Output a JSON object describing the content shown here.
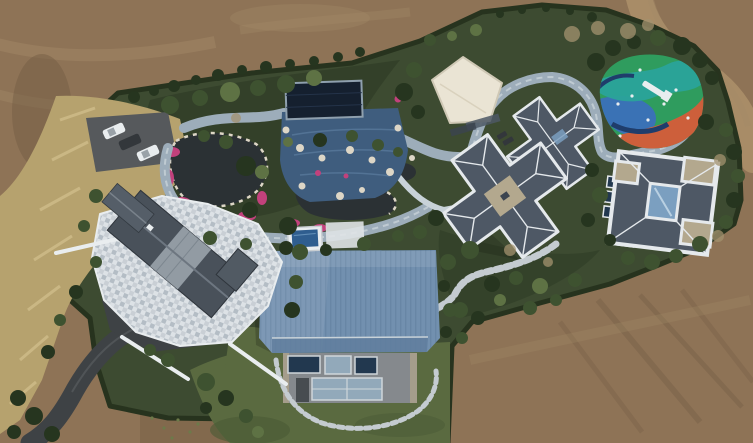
{
  "scene": {
    "type": "aerial-drone-photograph",
    "setting": "landscaped private estate surrounded by bare brown earth",
    "landmarks": [
      {
        "name": "parking-area",
        "vehicles_visible": 3
      },
      {
        "name": "ornamental-pond-garden",
        "features": [
          "dark pond",
          "pink flower beds",
          "white rocks"
        ]
      },
      {
        "name": "pool-pavilion",
        "features": [
          "dark navy cover",
          "blue tiled deck"
        ]
      },
      {
        "name": "cream-flat-roof-building"
      },
      {
        "name": "children-playground",
        "features": [
          "green blue teal orange painted surface",
          "white slide"
        ]
      },
      {
        "name": "slate-roof-villa-middle"
      },
      {
        "name": "slate-roof-villa-right",
        "features": [
          "white parapet",
          "glass courtyard"
        ]
      },
      {
        "name": "blue-metal-roof-barn",
        "features": [
          "corrugated steel-blue roof",
          "windows",
          "curved stepping-stone path"
        ]
      },
      {
        "name": "terrace-house",
        "features": [
          "dark gable roof",
          "light mosaic terrace"
        ]
      },
      {
        "name": "winding-garden-paths"
      },
      {
        "name": "asphalt-access-road"
      },
      {
        "name": "dirt-road-top-right"
      },
      {
        "name": "boundary-hedge"
      }
    ]
  },
  "palette": {
    "dirtBase": "#8e7356",
    "dirtLight": "#a38a68",
    "dirtDark": "#715a42",
    "dirtRoad": "#a88c67",
    "hedge": "#27331e",
    "garden": "#3d4b31",
    "gardenDark": "#2f3c27",
    "lawn": "#5a6a40",
    "lawnDark": "#4a5a36",
    "dryGrass": "#b6a26e",
    "dryGrassLight": "#cfbd8a",
    "bushOlive": "#5c6240",
    "treeDark": "#26351f",
    "treeMid": "#3e5230",
    "treeLight": "#5e7244",
    "treeBare": "#a3926f",
    "path": "#9dadba",
    "pathLight": "#c8d2d8",
    "stone": "#c4cbd0",
    "white": "#e9edef",
    "asphalt": "#3e4245",
    "parking": "#56595c",
    "carDark": "#33373b",
    "pond": "#2b3134",
    "flower": "#c2417c",
    "rock": "#ddd6c6",
    "poolNavy": "#15202f",
    "poolDeck": "#3f5d7e",
    "poolWater": "#2f5e8f",
    "cream": "#eae4d4",
    "slate": "#4e5865",
    "slateDark": "#3b4450",
    "ridge": "#e5e9ec",
    "tanRoof": "#b3a88e",
    "glass": "#7b9fc0",
    "barnRoof": "#7290af",
    "barnRoofDark": "#607e9e",
    "barnWall": "#85898d",
    "barnWinDark": "#22384f",
    "barnWinLight": "#92a9ba",
    "playGreen": "#2f9c5e",
    "playBlue": "#3a72b5",
    "playTeal": "#2aa39a",
    "playOrange": "#cd5f3b",
    "playNavy": "#1f3d6b"
  }
}
